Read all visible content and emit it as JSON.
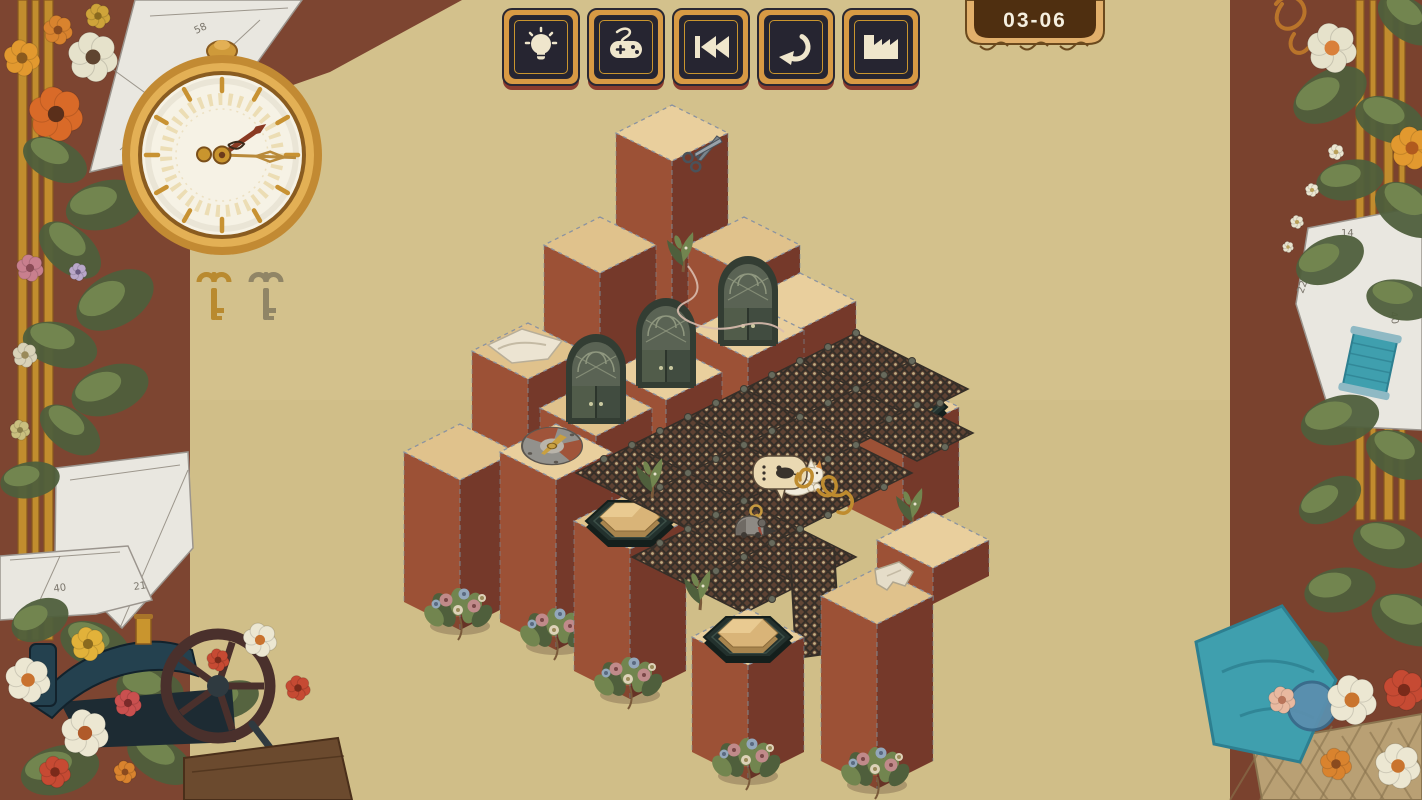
{
  "window": {
    "width": 1422,
    "height": 800
  },
  "colors": {
    "bg": "#d3c18c",
    "bg2": "#cdbb83",
    "strip": "#7d4531",
    "stripR": "#7a422e",
    "tileTop": "#e9cf9d",
    "tileTopAlt": "#e0c28c",
    "tileEdge": "#8b93a0",
    "faceL": "#9c5136",
    "faceR": "#75392a",
    "mesh": "#5e4233",
    "meshLine": "#362f28",
    "meshDot": "#cdbb8e",
    "meshTrim": "#676a5c",
    "doorFrame": "#333d33",
    "door": "#515c4a",
    "doorDark": "#414c40",
    "doorArch": "#5a6354",
    "hexBase": "#23312d",
    "hexBaseEdge": "#141f1c",
    "hexTop": "#d9b478",
    "hexTopLight": "#ecd097",
    "gold": "#c9952e",
    "goldDark": "#8a5a1e",
    "cream": "#efe6cc",
    "ink": "#262531",
    "btnFrame": "#d89a44",
    "btnShadow": "#8a3b2e",
    "badgeBg": "#4f2f10",
    "badgeFrame": "#e2b06b",
    "badgeText": "#f5efdf",
    "badgeEdge": "#6b4a1e",
    "clockRim": "#cf9a3a",
    "clockRimDark": "#8a5c20",
    "clockFace": "#f6f2e5",
    "clockTick": "#c89232",
    "handRed": "#8a3a22",
    "handGold": "#b98a3a",
    "leaf": "#72854f",
    "leafDark": "#4f5f3c",
    "stem": "#7a5a3a",
    "flowerPink": "#c08a8a",
    "flowerBlue": "#93a7bb",
    "flowerCream": "#ddd2b8",
    "paper": "#e9e7e0",
    "paperLine": "#9b958e",
    "machineBody": "#24414f",
    "machineDark": "#1d2b33",
    "wheel": "#4a302c",
    "teal": "#3f9fae",
    "tealDark": "#2d7f90",
    "wood": "#6b4a2e",
    "woodDark": "#4a2f1a",
    "basket": "#b9a074",
    "basketLine": "#8a744f",
    "threadPale": "#d9bcae",
    "threadGold": "#bf8c2f"
  },
  "hud": {
    "toolbar": {
      "x": 502,
      "y": 8,
      "size": 74,
      "gap": 11,
      "buttons": [
        {
          "name": "hint",
          "icon": "lightbulb-icon"
        },
        {
          "name": "controls",
          "icon": "gamepad-icon"
        },
        {
          "name": "skip-to-start",
          "icon": "rewind-icon"
        },
        {
          "name": "restart",
          "icon": "restart-icon"
        },
        {
          "name": "factory",
          "icon": "factory-icon"
        }
      ]
    },
    "level_badge": {
      "x": 962,
      "y": 0,
      "w": 146,
      "h": 46,
      "label": "03-06"
    },
    "clock": {
      "cx": 222,
      "cy": 155,
      "r": 100,
      "hour_angle_deg": 55,
      "minute_angle_deg": 92
    },
    "keys": {
      "x1": 214,
      "x2": 266,
      "y": 286,
      "earned": 1,
      "total": 2
    }
  },
  "scene": {
    "iso": {
      "hw": 56,
      "hh": 28
    },
    "columns_back": [
      {
        "x": 672,
        "y": 133,
        "shaft": 280,
        "item": "scissors"
      },
      {
        "x": 744,
        "y": 245,
        "shaft": 150
      },
      {
        "x": 800,
        "y": 301,
        "shaft": 70
      },
      {
        "x": 600,
        "y": 245,
        "shaft": 260
      },
      {
        "x": 748,
        "y": 330,
        "shaft": 90,
        "door": true
      },
      {
        "x": 528,
        "y": 351,
        "shaft": 230,
        "item": "fabric",
        "flowers": true
      },
      {
        "x": 666,
        "y": 372,
        "shaft": 130,
        "door": true
      },
      {
        "x": 596,
        "y": 408,
        "shaft": 180,
        "door": true,
        "flowers": true
      },
      {
        "x": 903,
        "y": 407,
        "shaft": 100,
        "item": "hex"
      },
      {
        "x": 460,
        "y": 452,
        "shaft": 150,
        "flowers": true
      },
      {
        "x": 556,
        "y": 452,
        "shaft": 170,
        "item": "disc",
        "flowers": true
      },
      {
        "x": 630,
        "y": 521,
        "shaft": 150,
        "item": "hex",
        "flowers": true
      }
    ],
    "mesh_tiles": [
      [
        856,
        361
      ],
      [
        800,
        389
      ],
      [
        912,
        389
      ],
      [
        744,
        417
      ],
      [
        856,
        417
      ],
      [
        917,
        433
      ],
      [
        688,
        445
      ],
      [
        800,
        445
      ],
      [
        632,
        473
      ],
      [
        744,
        473
      ],
      [
        856,
        473
      ],
      [
        688,
        501
      ],
      [
        800,
        501
      ],
      [
        744,
        529
      ],
      [
        688,
        557
      ],
      [
        800,
        557
      ],
      [
        744,
        585
      ]
    ],
    "columns_front": [
      {
        "x": 933,
        "y": 540,
        "shaft": 36
      },
      {
        "x": 877,
        "y": 596,
        "shaft": 165,
        "item": "glove",
        "flowers": true
      },
      {
        "x": 748,
        "y": 637,
        "shaft": 115,
        "item": "hex",
        "flowers": true
      }
    ],
    "plants": [
      [
        683,
        272
      ],
      [
        652,
        498
      ],
      [
        700,
        610
      ],
      [
        912,
        528
      ]
    ],
    "loose_thread": "M688,266 q20,26 -2,36 q-18,9 4,20 q24,11 50,4 q28,-8 44,6",
    "gold_thread": {
      "x": 826,
      "y": 486
    },
    "cat": {
      "x": 801,
      "y": 484
    },
    "mouse": {
      "x": 752,
      "y": 523
    },
    "bubble": {
      "x": 780,
      "y": 473
    },
    "hanging_net": "790,548 834,548 840,652 796,658"
  },
  "deco": {
    "left": {
      "bars": [
        [
          18,
          0,
          9,
          640
        ],
        [
          32,
          0,
          7,
          640
        ],
        [
          44,
          0,
          9,
          640
        ]
      ],
      "wedge": "285,0 462,0 330,72 222,110",
      "papers": [
        {
          "pts": "135,0 302,0 196,148 90,172",
          "labels": [
            {
              "t": "58",
              "x": 196,
              "y": 34,
              "r": -25
            }
          ],
          "lines": [
            "150,16 288,8",
            "120,150 260,20",
            "100,60 210,140"
          ]
        },
        {
          "pts": "56,468 188,452 193,548 122,628 55,560",
          "labels": [],
          "lines": [
            "70,480 180,465",
            "120,628 188,470"
          ]
        },
        {
          "pts": "0,556 128,546 152,600 96,614 0,620",
          "labels": [
            {
              "t": "40",
              "x": 54,
              "y": 592,
              "r": -8
            },
            {
              "t": "21",
              "x": 134,
              "y": 590,
              "r": -8
            }
          ],
          "lines": [
            "10,560 120,552",
            "60,556 40,600"
          ]
        }
      ],
      "flowers": [
        [
          22,
          58,
          16,
          "#e2992f",
          "#8a5a1e"
        ],
        [
          58,
          30,
          13,
          "#d9832e",
          "#8a4a1e"
        ],
        [
          98,
          16,
          11,
          "#cfa43a",
          "#8a6a1e"
        ],
        [
          93,
          57,
          22,
          "#e6e2cb",
          "#5f4530"
        ],
        [
          56,
          114,
          24,
          "#d96a28",
          "#5a2f1a"
        ],
        [
          30,
          268,
          12,
          "#c87f8e",
          "#8a4a55"
        ],
        [
          78,
          272,
          8,
          "#b9a7c9",
          "#6a5a80"
        ],
        [
          25,
          355,
          11,
          "#d9d2b8",
          "#9a8a5a"
        ],
        [
          20,
          430,
          9,
          "#c9bf7f",
          "#8a7f4a"
        ],
        [
          88,
          644,
          15,
          "#e2b23a",
          "#8a6a1e"
        ],
        [
          28,
          680,
          20,
          "#ece7d2",
          "#c9722e"
        ],
        [
          85,
          733,
          21,
          "#ece7d2",
          "#b05a2a"
        ],
        [
          128,
          703,
          12,
          "#c9504f",
          "#7a2a2a"
        ],
        [
          55,
          772,
          14,
          "#c64a33",
          "#7a2a1a"
        ],
        [
          125,
          772,
          10,
          "#d9832e",
          "#8a4a1e"
        ],
        [
          218,
          660,
          10,
          "#c64a33",
          "#7a2a1a"
        ],
        [
          260,
          640,
          15,
          "#ece7d2",
          "#c9722e"
        ],
        [
          298,
          688,
          11,
          "#c64a33",
          "#7a2a1a"
        ]
      ],
      "leaves": [
        [
          55,
          160,
          34,
          20,
          25
        ],
        [
          105,
          205,
          40,
          24,
          -15
        ],
        [
          70,
          250,
          36,
          22,
          40
        ],
        [
          115,
          300,
          42,
          26,
          -30
        ],
        [
          60,
          345,
          38,
          22,
          15
        ],
        [
          110,
          390,
          40,
          24,
          -20
        ],
        [
          70,
          430,
          34,
          20,
          35
        ],
        [
          30,
          480,
          30,
          18,
          -10
        ],
        [
          95,
          645,
          36,
          22,
          20
        ],
        [
          40,
          620,
          30,
          20,
          -25
        ],
        [
          150,
          690,
          34,
          22,
          10
        ],
        [
          60,
          770,
          40,
          24,
          -15
        ],
        [
          160,
          760,
          36,
          20,
          30
        ],
        [
          230,
          700,
          30,
          18,
          -20
        ]
      ]
    },
    "machine": {
      "wheel": [
        218,
        686,
        52
      ],
      "crank": [
        252,
        724,
        284,
        766
      ],
      "spool": [
        136,
        618
      ]
    },
    "right": {
      "bars": [
        [
          1356,
          0,
          8,
          520
        ],
        [
          1370,
          0,
          6,
          520
        ],
        [
          1384,
          0,
          9,
          520
        ],
        [
          1399,
          0,
          6,
          520
        ]
      ],
      "curl": "M1282,4 c-16,22 8,34 20,16 c10,-16 -12,-34 -26,-16 M1294,34 c-10,14 4,26 14,14",
      "paper": {
        "pts": "1308,228 1422,206 1422,430 1334,426 1296,304",
        "labels": [
          {
            "t": "14",
            "x": 1341,
            "y": 236,
            "r": 0
          },
          {
            "t": "22",
            "x": 1303,
            "y": 294,
            "r": -70
          },
          {
            "t": "40",
            "x": 1390,
            "y": 312,
            "r": 80
          }
        ]
      },
      "flowers": [
        [
          1332,
          48,
          22,
          "#e6e2cb",
          "#d9803a"
        ],
        [
          1412,
          148,
          19,
          "#e2992f",
          "#b05a1e"
        ],
        [
          1336,
          152,
          7,
          "#ece7d2",
          "#b9a05a"
        ],
        [
          1312,
          190,
          6,
          "#ece7d2",
          "#b9a05a"
        ],
        [
          1297,
          222,
          6,
          "#e9e4cf",
          "#b9a05a"
        ],
        [
          1288,
          247,
          5,
          "#e9e4cf",
          "#b9a05a"
        ],
        [
          1352,
          700,
          22,
          "#ece7d2",
          "#c9742e"
        ],
        [
          1404,
          690,
          18,
          "#c64a33",
          "#7a2a1a"
        ],
        [
          1336,
          764,
          14,
          "#d9832e",
          "#8a4a1e"
        ],
        [
          1398,
          766,
          20,
          "#ece7d2",
          "#c9742e"
        ],
        [
          1282,
          700,
          12,
          "#e9b9a0",
          "#b9745a"
        ]
      ],
      "leaves": [
        [
          1330,
          95,
          40,
          24,
          -30
        ],
        [
          1390,
          120,
          36,
          22,
          20
        ],
        [
          1350,
          180,
          34,
          20,
          -10
        ],
        [
          1410,
          210,
          38,
          24,
          30
        ],
        [
          1330,
          260,
          36,
          22,
          -25
        ],
        [
          1400,
          300,
          34,
          20,
          10
        ],
        [
          1340,
          420,
          40,
          24,
          -15
        ],
        [
          1400,
          455,
          36,
          22,
          25
        ],
        [
          1330,
          500,
          34,
          20,
          -30
        ],
        [
          1390,
          545,
          38,
          22,
          15
        ],
        [
          1340,
          590,
          36,
          22,
          -10
        ],
        [
          1410,
          620,
          40,
          24,
          20
        ],
        [
          1300,
          660,
          30,
          18,
          -20
        ],
        [
          1408,
          20,
          34,
          20,
          35
        ]
      ],
      "spool": [
        1348,
        336,
        44,
        54,
        12
      ],
      "cloth": "1196,642 1282,606 1336,680 1300,762 1214,744",
      "jar": [
        1312,
        706,
        24
      ],
      "basket": "1252,744 1422,714 1422,800 1262,800"
    }
  }
}
